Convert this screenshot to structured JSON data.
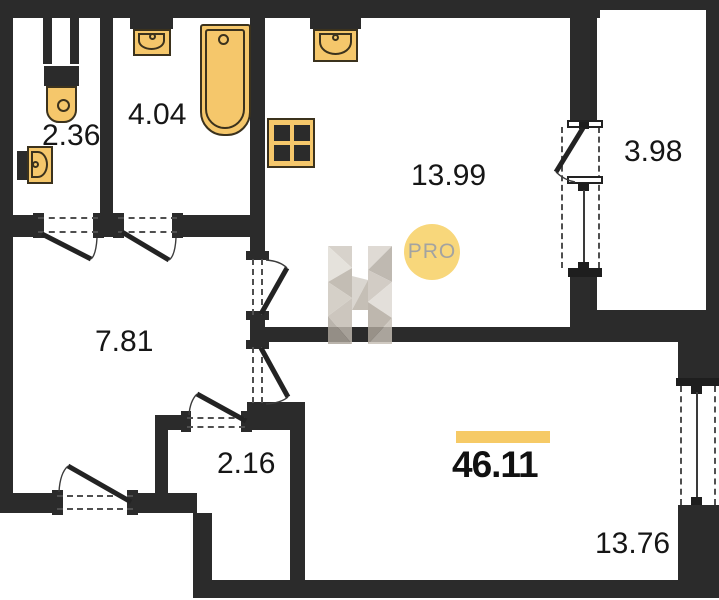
{
  "watermark": {
    "logo_letter": "H",
    "badge_label": "PRO"
  },
  "areas": {
    "wc": "2.36",
    "bathroom": "4.04",
    "kitchen": "13.99",
    "balcony": "3.98",
    "hallway": "7.81",
    "closet": "2.16",
    "living_room": "13.76",
    "total": "46.11"
  },
  "colors": {
    "wall": "#2b2b2b",
    "fixture_fill": "#f5c76b",
    "fixture_outline": "#3b321d",
    "total_accent_bar": "#f6ca66",
    "badge_background": "#f8d77b",
    "badge_text": "#a3a3a1",
    "label_text": "#161616"
  }
}
